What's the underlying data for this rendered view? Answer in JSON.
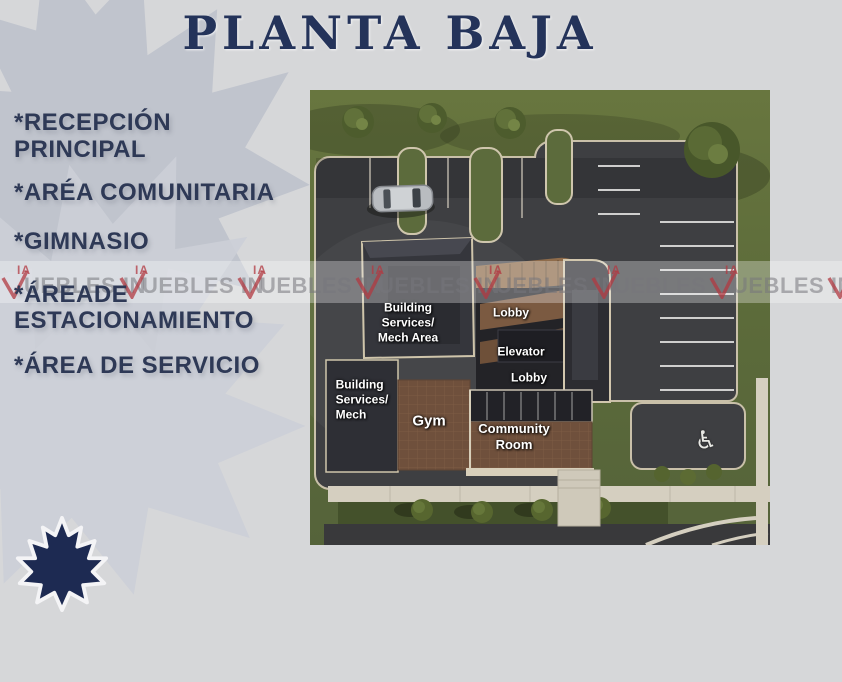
{
  "slide": {
    "title": "PLANTA BAJA"
  },
  "features": {
    "items": [
      "*RECEPCIÓN\nPRINCIPAL",
      "*ARÉA COMUNITARIA",
      "*GIMNASIO",
      "*ÁREADE\nESTACIONAMIENTO",
      "*ÁREA DE SERVICIO"
    ]
  },
  "floorplan": {
    "labels": {
      "mech_area": "Building\nServices/\nMech Area",
      "lobby_upper": "Lobby",
      "elevator": "Elevator",
      "lobby_lower": "Lobby",
      "mech": "Building\nServices/\nMech",
      "gym": "Gym",
      "community_room": "Community\nRoom"
    },
    "wheelchair_icon": "♿"
  },
  "watermark": {
    "prefix": "IA",
    "text": "UEBLES IN"
  },
  "colors": {
    "navy": "#24335a",
    "watermark_red": "#b23a42",
    "background": "#d6d7d9"
  }
}
